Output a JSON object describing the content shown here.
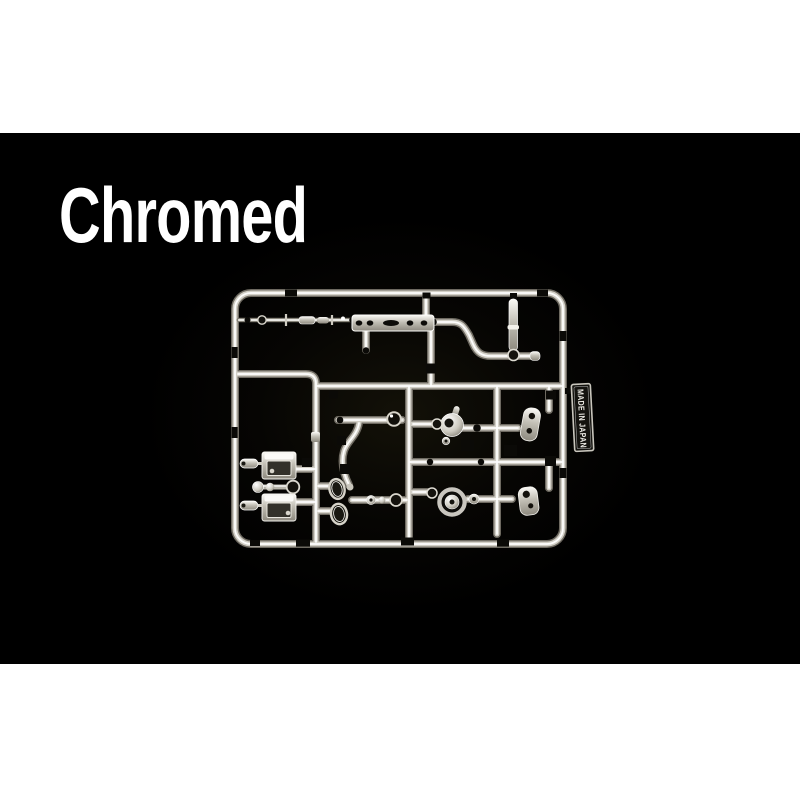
{
  "caption": {
    "title": "Chromed"
  },
  "sprue": {
    "tag_label": "MADE IN JAPAN"
  },
  "palette": {
    "letterbox": "#ffffff",
    "photo_background": "#000000",
    "caption_text": "#ffffff",
    "chrome_highlight": "#ffffff",
    "chrome_light": "#d2cfc6",
    "chrome_shadow": "#6e6a61"
  }
}
